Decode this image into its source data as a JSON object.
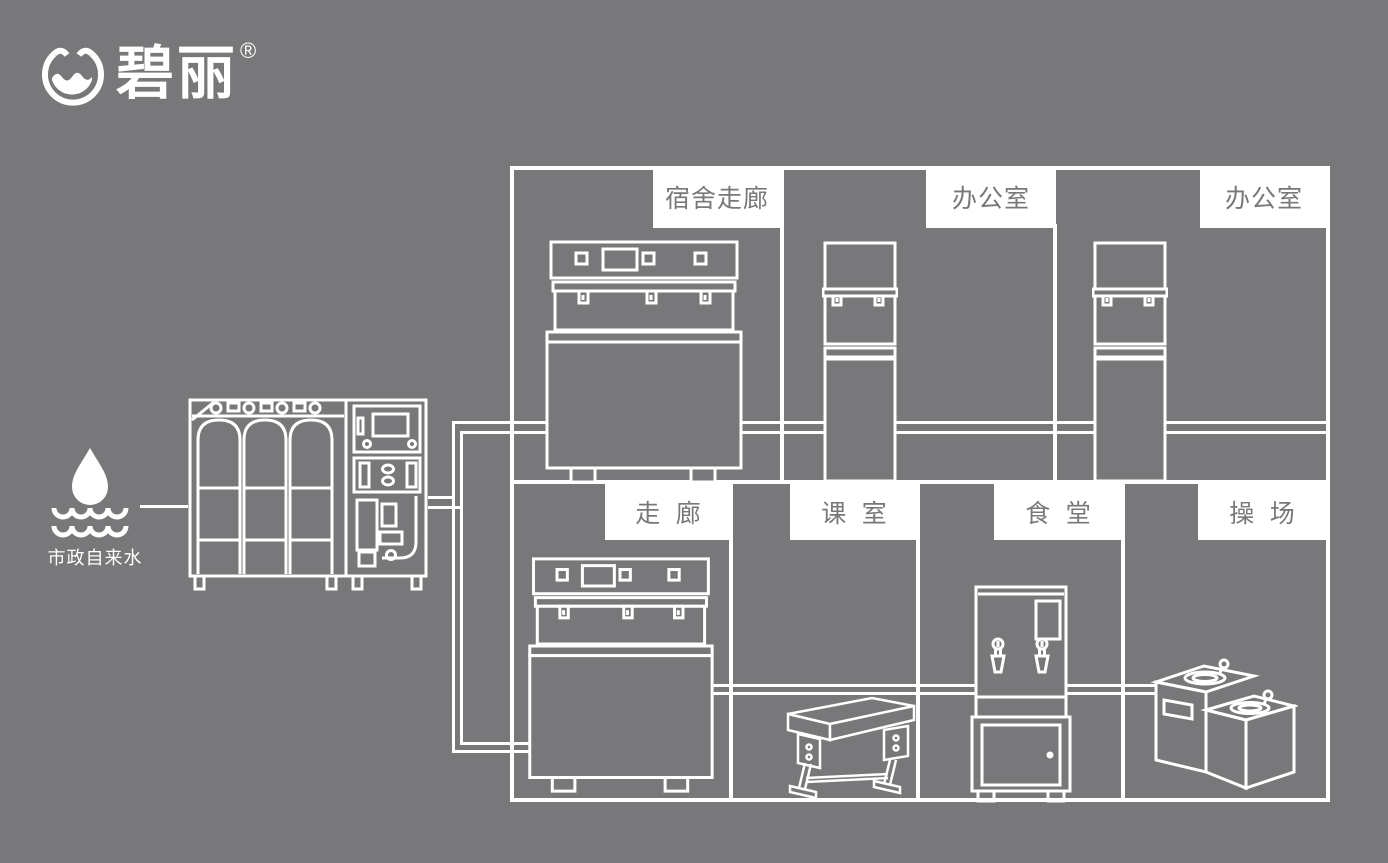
{
  "brand": {
    "name": "碧丽",
    "registered_mark": "®",
    "logo_icon": "water-bowl-icon"
  },
  "water_source": {
    "label": "市政自来水",
    "icon": "water-drop-waves-icon"
  },
  "rooms": {
    "top": [
      {
        "label": "宿舍走廊"
      },
      {
        "label": "办公室"
      },
      {
        "label": "办公室"
      }
    ],
    "bottom": [
      {
        "label": "走廊"
      },
      {
        "label": "课室"
      },
      {
        "label": "食堂"
      },
      {
        "label": "操场"
      }
    ]
  },
  "equipment": {
    "purifier": "reverse-osmosis-water-purification-system",
    "dorm_corridor_unit": "multi-tap-drinking-water-dispenser",
    "office_unit_1": "vertical-water-dispenser",
    "office_unit_2": "vertical-water-dispenser",
    "corridor_unit": "multi-tap-drinking-water-dispenser",
    "classroom_item": "school-desk",
    "canteen_unit": "water-boiler-on-cabinet",
    "playground_unit": "outdoor-two-tier-drinking-fountain"
  },
  "colors": {
    "background": "#78787b",
    "line": "#ffffff",
    "label_bg": "#ffffff",
    "label_text": "#78787b"
  }
}
